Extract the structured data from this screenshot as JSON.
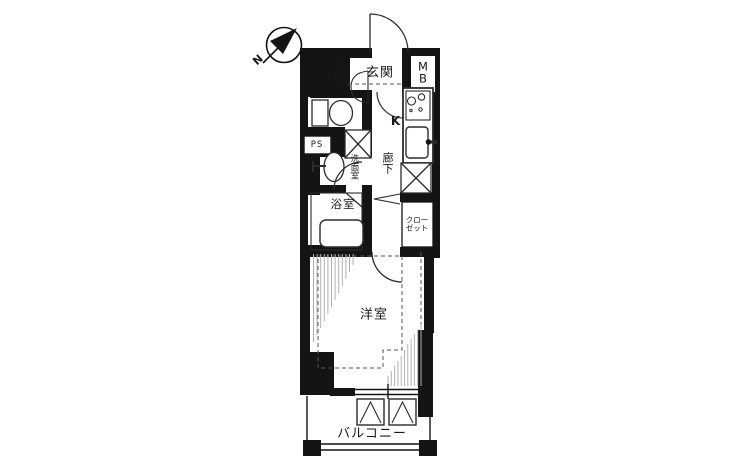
{
  "plan": {
    "compass": {
      "north_label": "N"
    },
    "rooms": {
      "genkan": "玄関",
      "shoe_box": "下足入",
      "meter_box": "MB",
      "kitchen": "K",
      "hallway": "廊下",
      "pipe_space": "PS",
      "washroom": "洗面室",
      "bathroom": "浴室",
      "closet": "クローゼット",
      "western_room": "洋室",
      "balcony": "バルコニー"
    },
    "colors": {
      "wall": "#141414",
      "line": "#2b2b2b",
      "hatch": "#b0b0b0",
      "dash": "#555555",
      "bg": "#ffffff"
    }
  }
}
